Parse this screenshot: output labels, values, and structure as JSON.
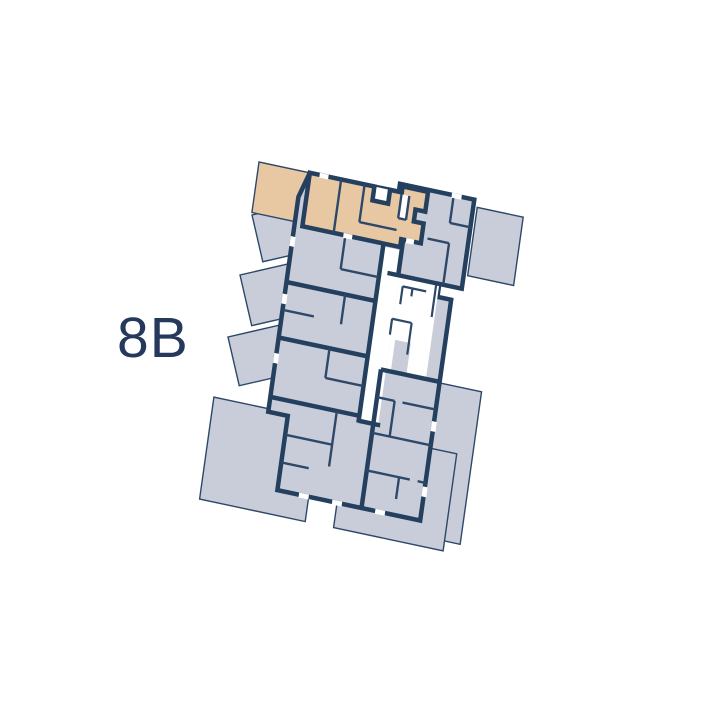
{
  "plan": {
    "label": "8B",
    "highlighted_unit": "8B",
    "type": "residential-floor-plan",
    "highlighted_position": "top-left"
  },
  "colors": {
    "background": "#ffffff",
    "wall": "#24405e",
    "wall-thin": "#2d4868",
    "unit-fill": "#c9cdd9",
    "highlight-fill": "#e8c7a3",
    "label-text": "#24395c",
    "void": "#ffffff"
  }
}
